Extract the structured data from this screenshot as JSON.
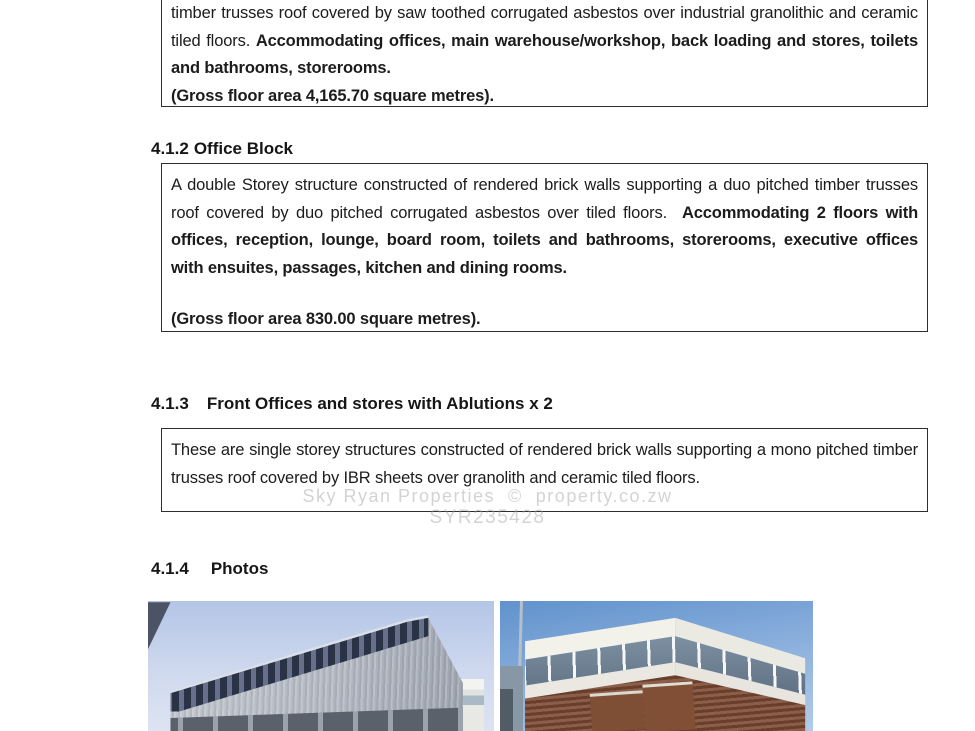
{
  "doc": {
    "box1": {
      "normal": "timber trusses roof covered by saw toothed corrugated asbestos over industrial granolithic and ceramic tiled floors. ",
      "bold": "Accommodating offices, main warehouse/workshop, back loading and stores, toilets and bathrooms, storerooms.",
      "gross": "(Gross floor area 4,165.70 square metres)."
    },
    "sec412": {
      "number": "4.1.2",
      "title": "Office Block",
      "normal": "A double Storey structure constructed of rendered brick walls supporting a duo pitched timber trusses roof covered by duo pitched corrugated asbestos over tiled floors.  ",
      "bold": "Accommodating 2 floors with offices, reception, lounge, board room, toilets and bathrooms, storerooms, executive offices with ensuites, passages, kitchen and dining rooms.",
      "gross": "(Gross floor area 830.00 square metres)."
    },
    "sec413": {
      "number": "4.1.3",
      "title": "Front Offices and stores with Ablutions x 2",
      "text": "These are single storey structures constructed of rendered brick walls supporting a mono pitched timber trusses roof covered by IBR sheets over granolith and ceramic tiled floors."
    },
    "sec414": {
      "number": "4.1.4",
      "title": "Photos"
    },
    "watermark": {
      "line1": "Sky Ryan Properties  ©  property.co.zw",
      "line2": "SYR235428"
    },
    "colors": {
      "text": "#1c1c1c",
      "box_border": "#2e2e2e",
      "watermark_gray": "#cfcfcf",
      "left_photo_sky": "#c0cfe9",
      "left_photo_roof": "#46506a",
      "right_photo_sky": "#6092cc",
      "right_photo_brick": "#7b4a33"
    }
  }
}
